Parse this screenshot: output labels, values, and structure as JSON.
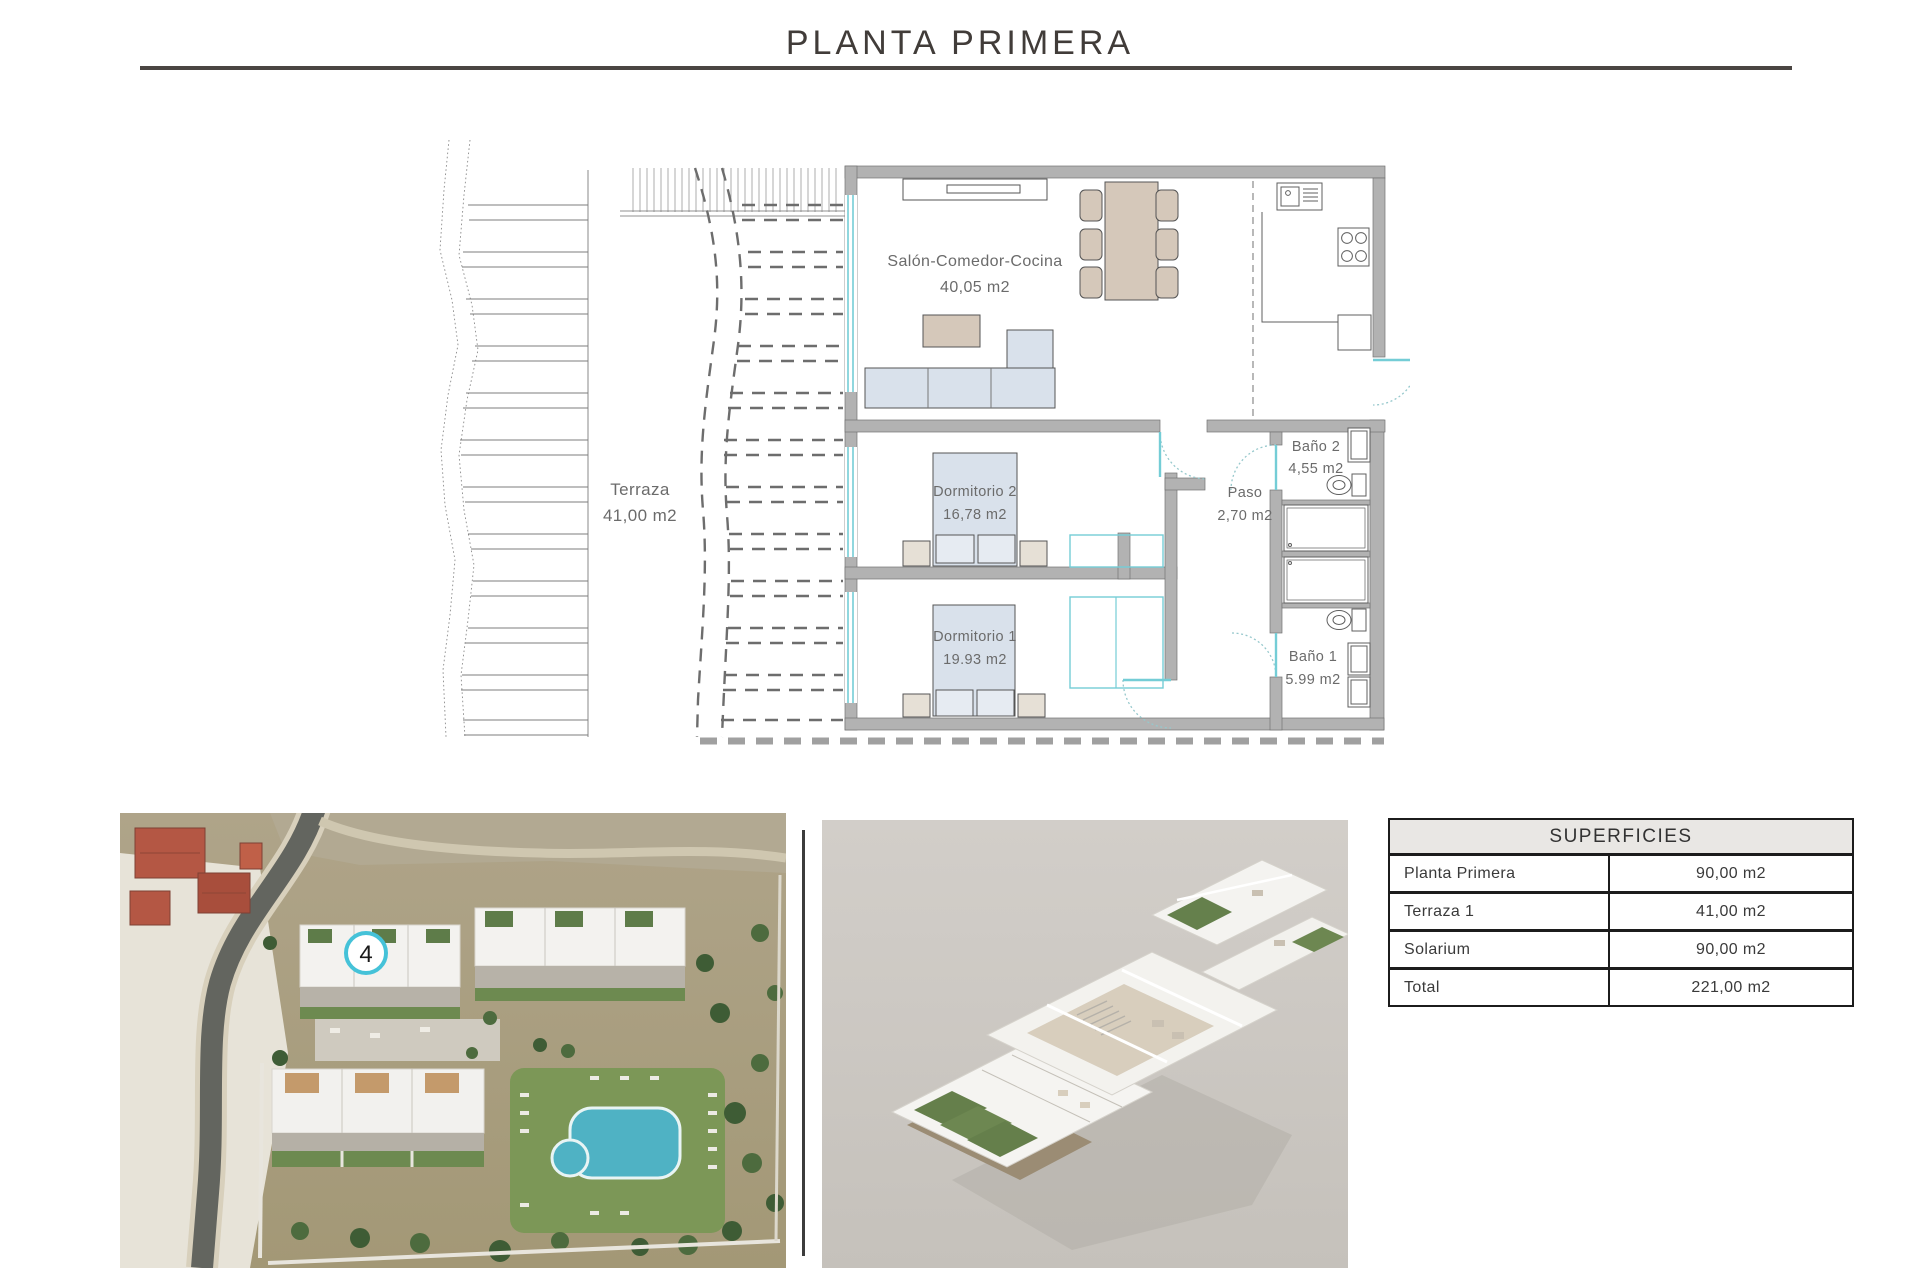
{
  "page": {
    "title": "PLANTA PRIMERA"
  },
  "plan": {
    "rooms": {
      "salon": {
        "name": "Salón-Comedor-Cocina",
        "area": "40,05 m2"
      },
      "terraza": {
        "name": "Terraza",
        "area": "41,00 m2"
      },
      "dormitorio2": {
        "name": "Dormitorio 2",
        "area": "16,78 m2"
      },
      "dormitorio1": {
        "name": "Dormitorio 1",
        "area": "19.93 m2"
      },
      "paso": {
        "name": "Paso",
        "area": "2,70 m2"
      },
      "bano2": {
        "name": "Baño 2",
        "area": "4,55 m2"
      },
      "bano1": {
        "name": "Baño 1",
        "area": "5.99 m2"
      }
    }
  },
  "site_photo": {
    "unit_badge": "4"
  },
  "surfaces_table": {
    "header": "SUPERFICIES",
    "rows": [
      {
        "label": "Planta Primera",
        "value": "90,00 m2"
      },
      {
        "label": "Terraza 1",
        "value": "41,00 m2"
      },
      {
        "label": "Solarium",
        "value": "90,00 m2"
      },
      {
        "label": "Total",
        "value": "221,00 m2"
      }
    ]
  },
  "colors": {
    "accent_cyan": "#74cdd6",
    "wall_gray": "#b2b2b2",
    "furniture_blue": "#d9e1eb",
    "furniture_tan": "#d5c8ba",
    "badge_ring": "#45c2d8",
    "table_border": "#1c1c1c",
    "title_gray": "#413c39"
  }
}
